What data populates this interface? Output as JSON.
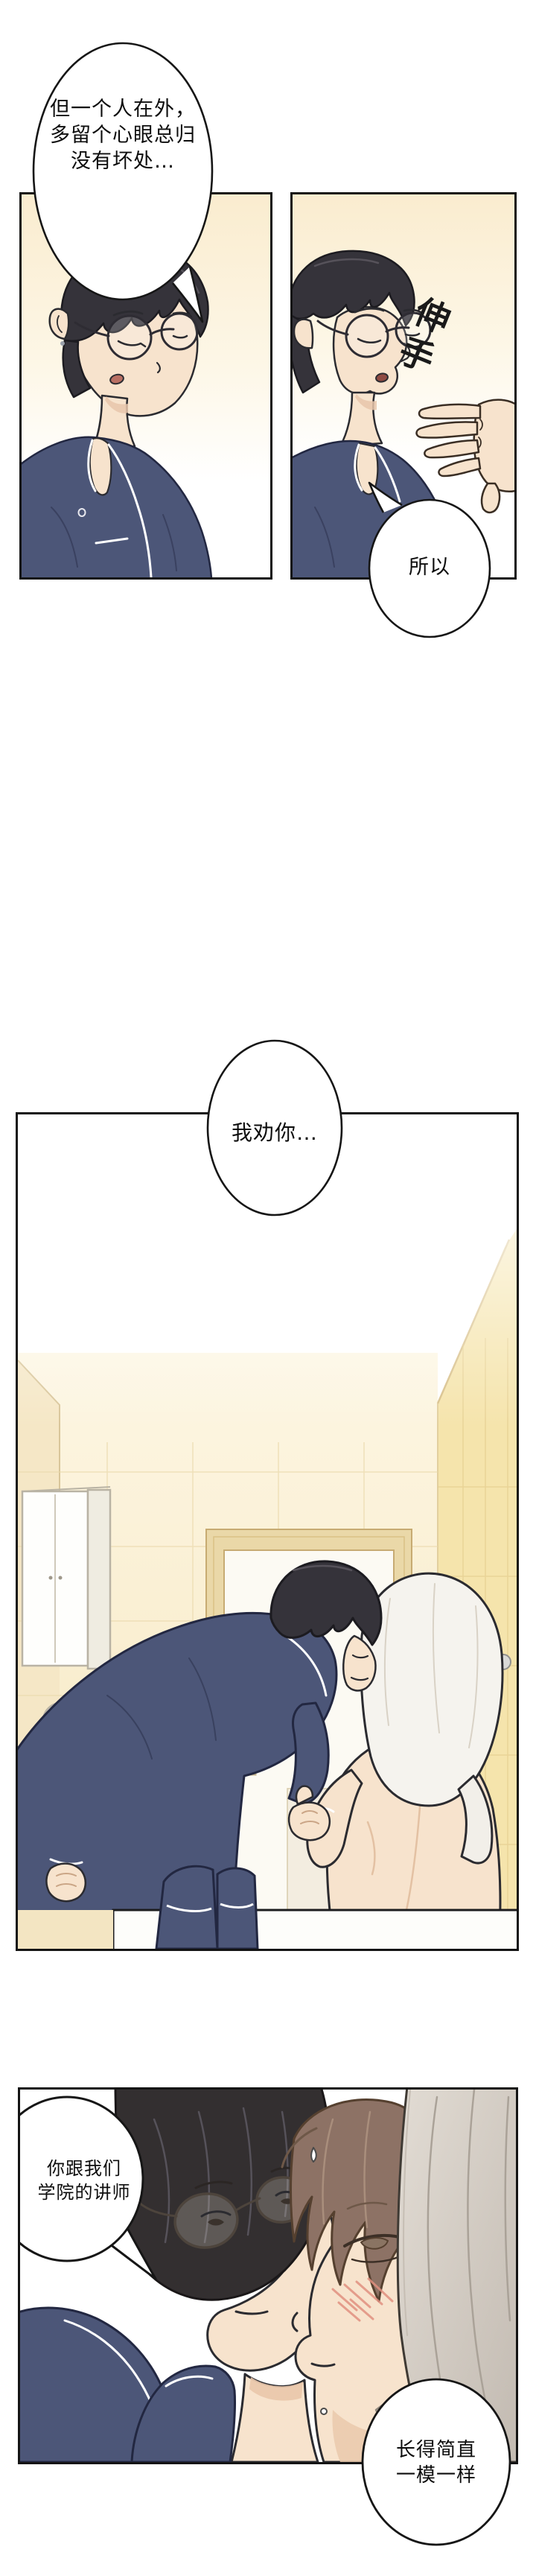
{
  "comic": {
    "bubbles": {
      "b1": {
        "line1": "但一个人在外，",
        "line2": "多留个心眼总归",
        "line3": "没有坏处…"
      },
      "b2": {
        "text": "所以"
      },
      "b3": {
        "text": "我劝你…"
      },
      "b4": {
        "line1": "你跟我们",
        "line2": "学院的讲师"
      },
      "b5": {
        "line1": "长得简直",
        "line2": "一模一样"
      }
    },
    "sfx": {
      "reach": "伸手"
    }
  },
  "colors": {
    "panel_border": "#141414",
    "wall_cream": "#f7e8c2",
    "wall_yellow": "#f5e4ac",
    "door_trim": "#ead8a8",
    "pajama_navy": "#4c5678",
    "hair_dark": "#35333a",
    "hair_brown": "#8d7265",
    "skin": "#f7e3cd",
    "towel_white": "#f5f3ee",
    "towel_gray": "#d8d1c9",
    "bubble_fill": "#ffffff",
    "bubble_stroke": "#161616"
  }
}
